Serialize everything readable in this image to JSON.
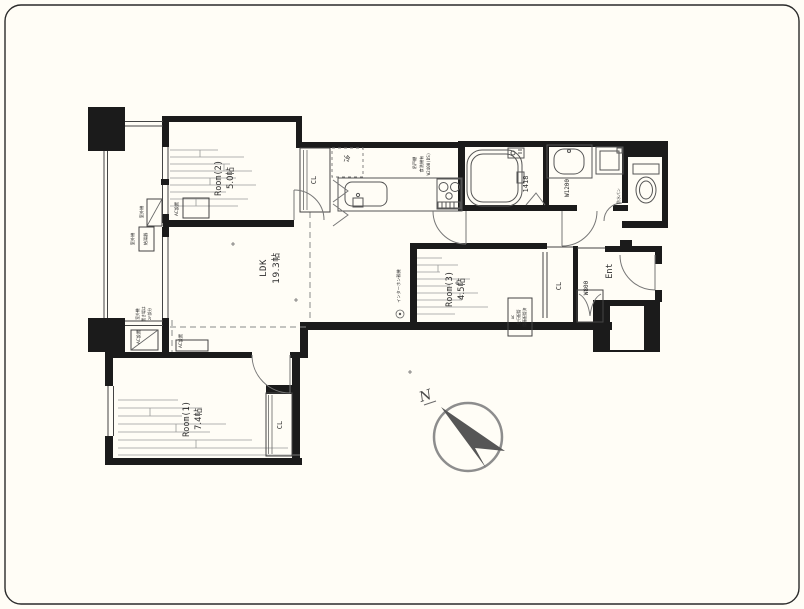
{
  "plan": {
    "rooms": {
      "room1": {
        "name": "Room(1)",
        "size": "7.4帖"
      },
      "room2": {
        "name": "Room(2)",
        "size": "5.0帖"
      },
      "room3": {
        "name": "Room(3)",
        "size": "4.5帖"
      },
      "ldk": {
        "name": "LDK",
        "size": "19.3帖"
      },
      "entrance": {
        "name": "Ent"
      }
    },
    "closets": {
      "kitchen_cl": "CL",
      "room3_cl": "CL",
      "room1_cl": "CL"
    },
    "fixtures": {
      "bath_unit_size": "1418",
      "vanity_width": "W1200",
      "shoe_cabinet_width": "W800",
      "refrigerator": "冷",
      "washer_pan": "防水パン",
      "kitchen_spec_1": "W2400(DS)",
      "kitchen_spec_2": "食洗機有",
      "kitchen_spec_3": "吊戸棚"
    },
    "notes": {
      "intercom": "インターホン親機",
      "ac_install": "AC設置",
      "outdoor_unit": "室外機",
      "water_heater": "給湯器",
      "outdoor_note_1": "室外機",
      "outdoor_note_2": "置き場は",
      "outdoor_note_3": "2F部分",
      "ac_piping_1": "AC",
      "ac_piping_2": "先行配管",
      "ac_piping_3": "隠蔽配管済"
    },
    "compass": {
      "north": "N"
    },
    "colors": {
      "wall": "#1b1b1b",
      "line": "#555555",
      "background": "#fffdf6"
    }
  }
}
